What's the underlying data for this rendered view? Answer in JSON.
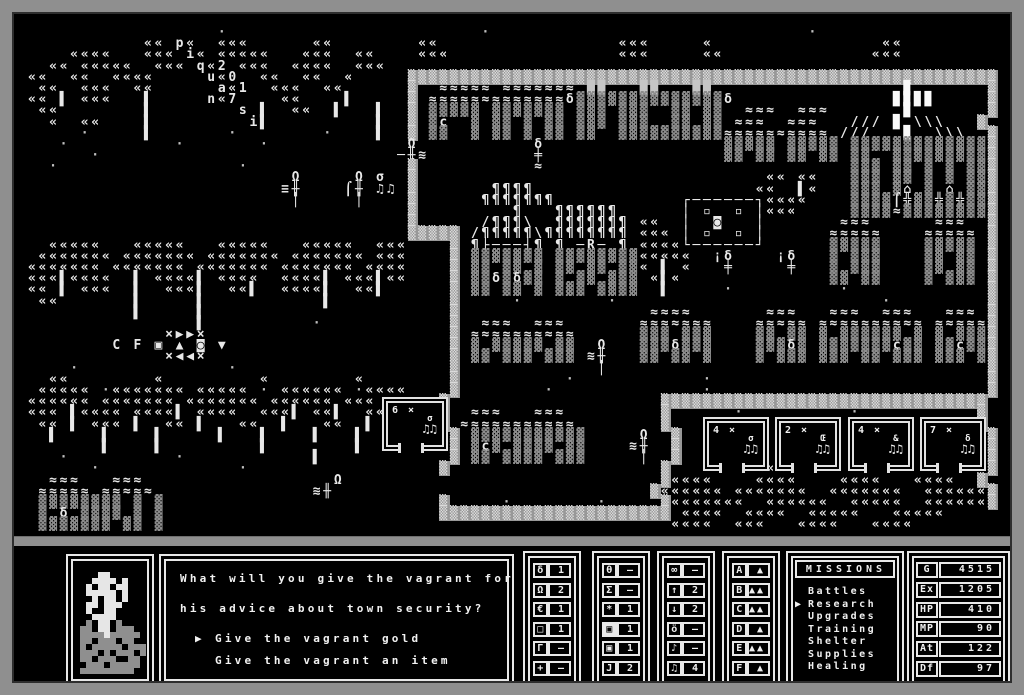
{
  "map": {
    "rows": [
      "                  ·                        ·                              ·",
      "           «« p«  «««      ««        ««                 «««     «                ««",
      "    ««««   ««« i« «««««   «««  ««    «««                «««     ««              «««",
      "  «« «««««  ««« q«2 «««  ««««  «««",
      "««  ««  ««««     u«0  ««  ««  «     ▒▒▒▒▒▒▒▒▒▒▒▒▒▒▒▒▒▒▒▒▒▒▒▒▒▒▒▒▒▒▒▒▒▒▒▒▒▒▒▒▒▒▒▒▒▒▒▒▒▒▒▒▒▒▒▒",
      " ««  «««  ««      a«1  «««  ««      ▒  ≈≈≈≈≈ ≈≈≈≈≈≈≈ ██   ██   ██                  ▉       ▒",
      "«« ▌ «««   ▌     n«7    ««    ▌     ▒ ≈≈≈≈≈≈≈≈≈≈≈≈≈δ▓▓▓▓▓▓▓▓▓▓▓▓▓▓δ               ▉▉▉▉     ▒",
      " ««        ▌        s ▌  ««  ▌   ▌  ▒ ▓▓▓▓▓ ▓▓▓▓▓▓▓ ▓▓▓ ▓▓▓  ▓▓ ▓▓  ≈≈≈  ≈≈≈       ▉       ▒",
      "  «  ««    ▌         i▌          ▌  ▒ ▓ç  ▓ ▓▓ ▓ ▓▓ ▓▓▓ ▓▓▓  ▓▓ ▓▓ ≈≈≈  ≈≈≈   /// ▉ \\\\\\   ▒",
      "     ·     ▌       ·        ·    ▌  ▒ ▓▓  ▓ ▓▓ ▓ ▓▓ ▓▓  ▓▓▓▓▓▓▓▓▓▓≈≈≈≈≈≈≈≈≈≈ ///   ▉  \\\\\\  ▒",
      "   ·          ·       ·             Ω           δ                 ▓▓▓▓▓ ▓▓▓▓▓ ▓▓▓▓▓▓▓▓▓▓▓▓▓▒",
      "      ·                            ─╫≋          ╪                 ▓▓ ▓▓ ▓▓ ▓▓ ▓▓  ▓▓▓▓▓▓▓▓▓▒",
      "  ·                 ·               ▒           ≈                             ▓▓▓ ▓▓ ▓ ▓ ▓▓▒",
      "                         Ω     Ω σ  ▒                                 «« ««   ▓▓▓ ▓▓ ▓ ▓ ▓▓▒",
      "                        ≡╫    ⌠╫ ♫♫ ▒       ¶¶¶¶                     ««  ▌«   ▓▓▓ ▓⌂ ▓ ⌂ ▓▓▒",
      "                         │     │    ▒      ¶¶¶¶¶¶¶            ┌──────┐««««    ▓▓▓▓⌠╬▓▓╬▓╬▓▓▒",
      "                                    ▒         ¶   ¶¶¶¶¶¶      │ ▫  ▫ │«««     ▓▓▓▓≈▓▓▓▓▓▓▓▓▒",
      "                                    ▒      /¶¶¶\\  ¶¶¶¶¶¶¶ ««  │  ◙   │       ≈≈≈      ≈≈≈  ▒",
      "                                    ▒▒▒▒▒ /¶¶¶¶¶\\¶¶¶¶¶¶¶¶ ««« │ ▫  ▫ │      ≈≈≈≈≈    ≈≈≈≈≈ ▒",
      "  «««««   «««««   «««««   «««««  «««    ▒ ¶├───┤¶ ¶ ─R─ ¶ ««««└──────┘      ▓▓▓▓▓    ▓▓▓▓▓ ▒",
      " ««««««« ««««««« ««««««« ««««««« «««    ▒ ▓▓▓▓▓▓▓ ▓▓▓▓▓▓▓▓«««««  ¡δ    ¡δ   ▓ ▓▓▓    ▓▓ ▓▓ ▒",
      "««««««« ««««««« ««««««« ««««««« ««««    ▒ ▓▓ ▓▓ ▓ ▓▓ ▓▓ ▓▓« ▌ «   ╪     ╪   ▓ ▓▓▓    ▓▓ ▓▓ ▒",
      "«««▌««««  ▌ ««««▌ ««««  ««««▌ «««▌««    ▒ ▓▓δ▓δ▓▓ ▓ ▓▓ ▓▓▓ «▌«              ▓▓ ▓▓    ▓ ▓▓▓ ▒",
      "«« ▌ «««  ▌  «««▌  ««▌  ««««▌  ««▌      ▒ ▓▓ ▓▓ ▓ ▓▓▓ ▓▓▓▓  ▌     ·          ·             ▒",
      " ««       ▌     ▌           ▌           ▒     ·        ·                         ·         ▒",
      "          ▌     ▌                       ▒                  ≈≈≈≈       ≈≈≈   ≈≈≈  ≈≈≈   ≈≈≈ ▒",
      "                ▌          ·            ▒  ≈≈≈  ≈≈≈       ≈≈≈≈≈≈≈    ≈≈≈≈≈ ≈≈≈≈≈≈≈≈≈≈ ≈≈≈≈≈▒",
      "             ×▶▶×                       ▒ ≈≈≈≈≈≈≈≈≈≈      ▓▓▓ ▓▓▓    ▓▓ ▓▓ ▓ ▓▓▓▓▓▓ ▓ ▓ ▓▓▓▒",
      "        C F ▣ ▲ ◙ ▼                     ▒ ▓ ▓▓▓▓▓ ▓▓  Ω   ▓▓▓δ▓▓▓    ▓▓▓δ▓ ▓▓▓▓▓▓▓ç▓▓ ▓▓ç▓▓▒",
      "             ×◀◀×                       ▒ ▓▓ ▓▓▓ ▓▓▓ ≋╫   ▓▓ ▓▓ ▓    ▓ ▓▓▓ ▓▓▓ ▓▓ ▓▓▓ ▓▓▓ ▓▒",
      "    ·              ·                    ▒             │                                    ▒",
      "  ««        «         «        «        ▒          ·            ·                          ▒",
      " ««««« ·««««««« ««««« · «««««« ·««««    ▒        ·              ·                          ▒",
      "«««««« ««««««« ««««««« «««««« «««      ▒                    ▒▒▒▒▒▒▒▒▒▒▒▒▒▒▒▒▒▒▒▒▒▒▒▒▒▒▒▒▒▒▒",
      "««« ▌«««« ««««▌ ««««  «««▌ ««▌  ««     ▒  ≈≈≈   ≈≈≈         ▒      ·          ·           ▒",
      " «« ▌ ««« ▌  «« ▌   ««  ▌   ««  ▌      ▒ ≈≈≈≈≈≈≈≈≈≈≈        ▒                             ▒",
      "  ▌    ▌    ▌     ▌   ▌    ▌   ▌        ▒ ▓▓▓▓▓▓▓▓▓▓▓     Ω  ▒                             ▒",
      "       ▌    ▌         ▌        ▌        ▒ ▓ç▓ ▓▓▓▓ ▓▓    ≋╫  ▒      ·              ·       ▒",
      "   ·          ·            ▌            ▒ ▓▓ ▓▓▓▓ ▓▓▓     │  ▒                       ««««  ▒",
      "      ·             ·                  ▒                    ▒        «««             ««««  ▒",
      "  ≈≈≈   ≈≈≈                  Ω                              ▒««««    ««««    ««««   ««««  ▒",
      " ≈≈≈≈≈ ≈≈≈≈≈               ≋╫                              ▒«««««« «««««««  «««««««  ««««««▒",
      " ▓▓▓▓▓▓▓▓ ▓ ▓                          ▒     ·        ·     ▒«««««««  ««««««  «««««  ««««««▒",
      " ▓ δ ▓▓▓▓ ▓ ▓                          ▒▒▒▒▒▒▒▒▒▒▒▒▒▒▒▒▒▒▒▒▒▒ ««««  ««««  «««««   «««««",
      " ▓▓▓▓▓▓▓ ▓▓ ▓                                                ««««  «««   ««««   ««««"
    ],
    "encounters": [
      {
        "x": 382,
        "y": 397,
        "count": "6 ×",
        "unit": "σ",
        "notes": "♫♫"
      },
      {
        "x": 703,
        "y": 417,
        "count": "4 ×",
        "unit": "σ",
        "notes": "♫♫"
      },
      {
        "x": 775,
        "y": 417,
        "count": "2 ×",
        "unit": "Œ",
        "notes": "♫♫"
      },
      {
        "x": 848,
        "y": 417,
        "count": "4 ×",
        "unit": "&",
        "notes": "♫♫"
      },
      {
        "x": 920,
        "y": 417,
        "count": "7 ×",
        "unit": "δ",
        "notes": "♫♫"
      }
    ]
  },
  "portrait": {
    "pixels": [
      "            ",
      "    WW      ",
      "   WWWW W   ",
      "  W WW WW   ",
      "  WWWWW W   ",
      "   W WW W   ",
      "  WW WWW    ",
      "  W  WW     ",
      "   WWWW     ",
      "  g WW g    ",
      " gg WW ggg  ",
      " ggggWggggg ",
      " gg ggg gg  ",
      " g ggggg ggg",
      " ggg g ggg g",
      " gg ggg  gg ",
      "  ggg ggggg ",
      " ggggggggg  "
    ]
  },
  "dialog": {
    "lines": [
      "What will you give the vagrant for",
      "his advice about town security?"
    ],
    "selector": "▶",
    "options": [
      {
        "label": "Give the vagrant gold",
        "selected": true
      },
      {
        "label": "Give the vagrant an item",
        "selected": false
      }
    ]
  },
  "unit_panels": [
    {
      "rows": [
        {
          "s": "δ",
          "v": "1",
          "hl": false
        },
        {
          "s": "Ω",
          "v": "2",
          "hl": false
        },
        {
          "s": "€",
          "v": "1",
          "hl": false
        },
        {
          "s": "□",
          "v": "1",
          "hl": false
        },
        {
          "s": "Γ",
          "v": "–",
          "hl": false
        },
        {
          "s": "+",
          "v": "–",
          "hl": false
        }
      ]
    },
    {
      "rows": [
        {
          "s": "θ",
          "v": "–",
          "hl": false
        },
        {
          "s": "Σ",
          "v": "–",
          "hl": false
        },
        {
          "s": "*",
          "v": "1",
          "hl": false
        },
        {
          "s": "▣",
          "v": "1",
          "hl": true
        },
        {
          "s": "▣",
          "v": "1",
          "hl": false
        },
        {
          "s": "J",
          "v": "2",
          "hl": false
        }
      ]
    },
    {
      "rows": [
        {
          "s": "∞",
          "v": "–",
          "hl": false
        },
        {
          "s": "↑",
          "v": "2",
          "hl": false
        },
        {
          "s": "↓",
          "v": "2",
          "hl": false
        },
        {
          "s": "ö",
          "v": "–",
          "hl": false
        },
        {
          "s": "♪",
          "v": "–",
          "hl": false
        },
        {
          "s": "♫",
          "v": "4",
          "hl": false
        }
      ]
    },
    {
      "rows": [
        {
          "s": "A",
          "v": "▲",
          "hl": false
        },
        {
          "s": "B",
          "v": "▲▲",
          "hl": false
        },
        {
          "s": "C",
          "v": "▲▲",
          "hl": false
        },
        {
          "s": "D",
          "v": "▲",
          "hl": false
        },
        {
          "s": "E",
          "v": "▲▲",
          "hl": false
        },
        {
          "s": "F",
          "v": "▲",
          "hl": false
        }
      ]
    }
  ],
  "missions": {
    "title": "MISSIONS",
    "selector": "▶",
    "items": [
      {
        "label": "Battles",
        "selected": false
      },
      {
        "label": "Research",
        "selected": true
      },
      {
        "label": "Upgrades",
        "selected": false
      },
      {
        "label": "Training",
        "selected": false
      },
      {
        "label": "Shelter",
        "selected": false
      },
      {
        "label": "Supplies",
        "selected": false
      },
      {
        "label": "Healing",
        "selected": false
      }
    ]
  },
  "stats": {
    "rows": [
      {
        "label": "G",
        "value": "4515"
      },
      {
        "label": "Ex",
        "value": "1205"
      },
      {
        "label": "HP",
        "value": "410"
      },
      {
        "label": "MP",
        "value": "90"
      },
      {
        "label": "At",
        "value": "122"
      },
      {
        "label": "Df",
        "value": "97"
      }
    ]
  }
}
